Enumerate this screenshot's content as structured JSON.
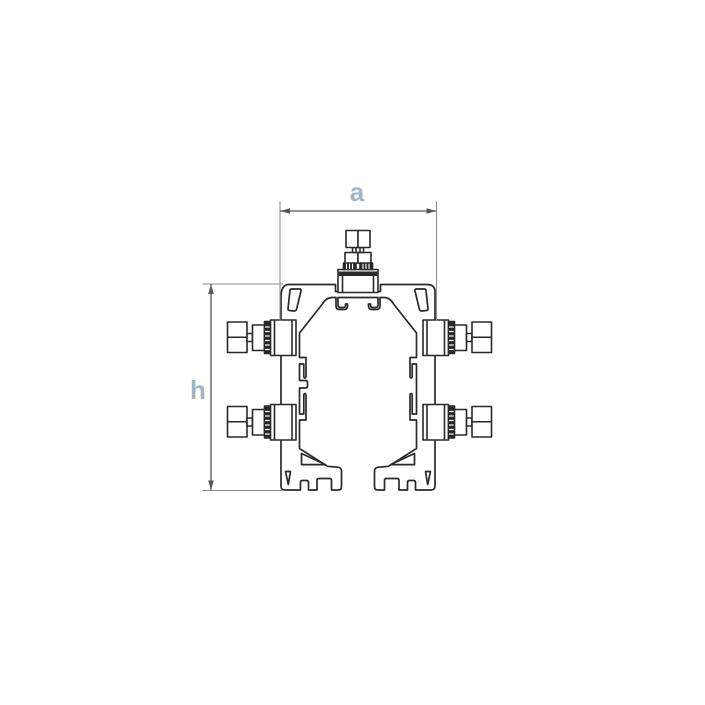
{
  "drawing": {
    "title": "profile cross-section technical drawing",
    "dimensions": {
      "width_label": "a",
      "height_label": "h"
    },
    "colors": {
      "line_art": "#2b2828",
      "dimension_line": "#55565a",
      "extension_line": "#8b8d90",
      "dimension_label": "#9fb5c4",
      "background": "#ffffff"
    }
  }
}
